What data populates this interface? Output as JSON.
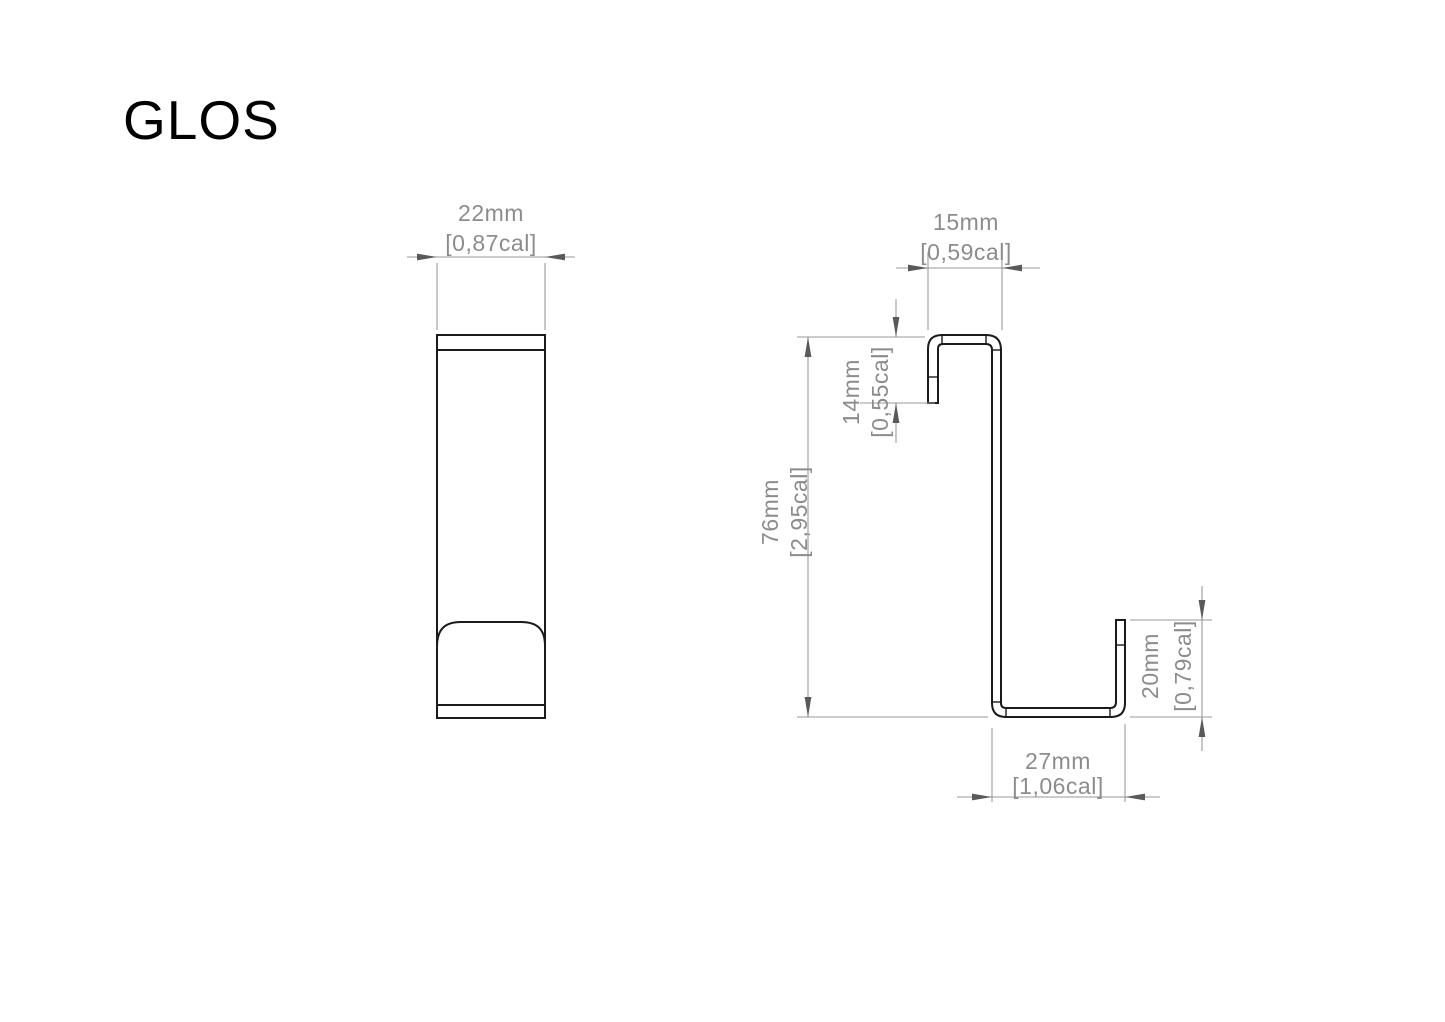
{
  "title": "GLOS",
  "dimensions": {
    "front_width": {
      "mm": "22mm",
      "cal": "[0,87cal]"
    },
    "top_hook_width": {
      "mm": "15mm",
      "cal": "[0,59cal]"
    },
    "front_lip_height": {
      "mm": "14mm",
      "cal": "[0,55cal]"
    },
    "total_height": {
      "mm": "76mm",
      "cal": "[2,95cal]"
    },
    "back_lip_height": {
      "mm": "20mm",
      "cal": "[0,79cal]"
    },
    "bottom_depth": {
      "mm": "27mm",
      "cal": "[1,06cal]"
    }
  },
  "colors": {
    "background": "#ffffff",
    "outline": "#1b1b1b",
    "dimension_line": "#9a9a9a",
    "dimension_text": "#8c8c8c",
    "arrow": "#5a5a5a"
  }
}
